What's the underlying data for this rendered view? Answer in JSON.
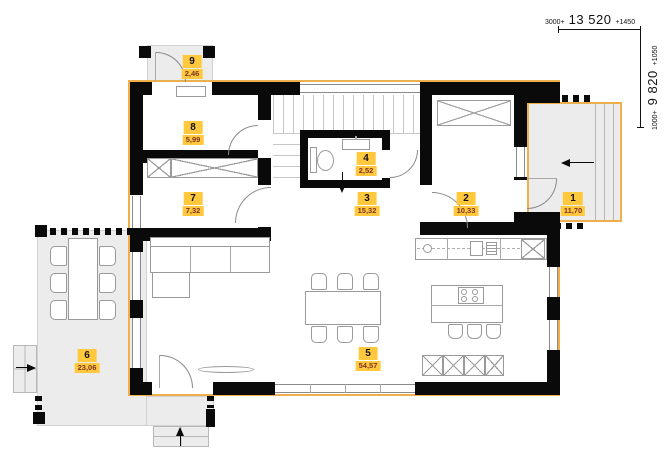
{
  "plan": {
    "dim_top": {
      "pre": "3000+",
      "main": "13 520",
      "post": "+1450"
    },
    "dim_right": {
      "pre": "1000+",
      "main": "9 820",
      "post": "+1050"
    },
    "rooms": {
      "r1": {
        "num": "1",
        "area": "11,70"
      },
      "r2": {
        "num": "2",
        "area": "10,33"
      },
      "r3": {
        "num": "3",
        "area": "15,32"
      },
      "r4": {
        "num": "4",
        "area": "2,52"
      },
      "r5": {
        "num": "5",
        "area": "54,57"
      },
      "r6": {
        "num": "6",
        "area": "23,06"
      },
      "r7": {
        "num": "7",
        "area": "7,32"
      },
      "r8": {
        "num": "8",
        "area": "5,99"
      },
      "r9": {
        "num": "9",
        "area": "2,46"
      }
    },
    "colors": {
      "wall": "#0a0a0a",
      "exterior_outline": "#eeb04c",
      "badge_bg": "#ffc83d",
      "badge_number_text": "#111111",
      "badge_area_text": "#7d342a",
      "exterior_floor": "#ececec"
    }
  }
}
